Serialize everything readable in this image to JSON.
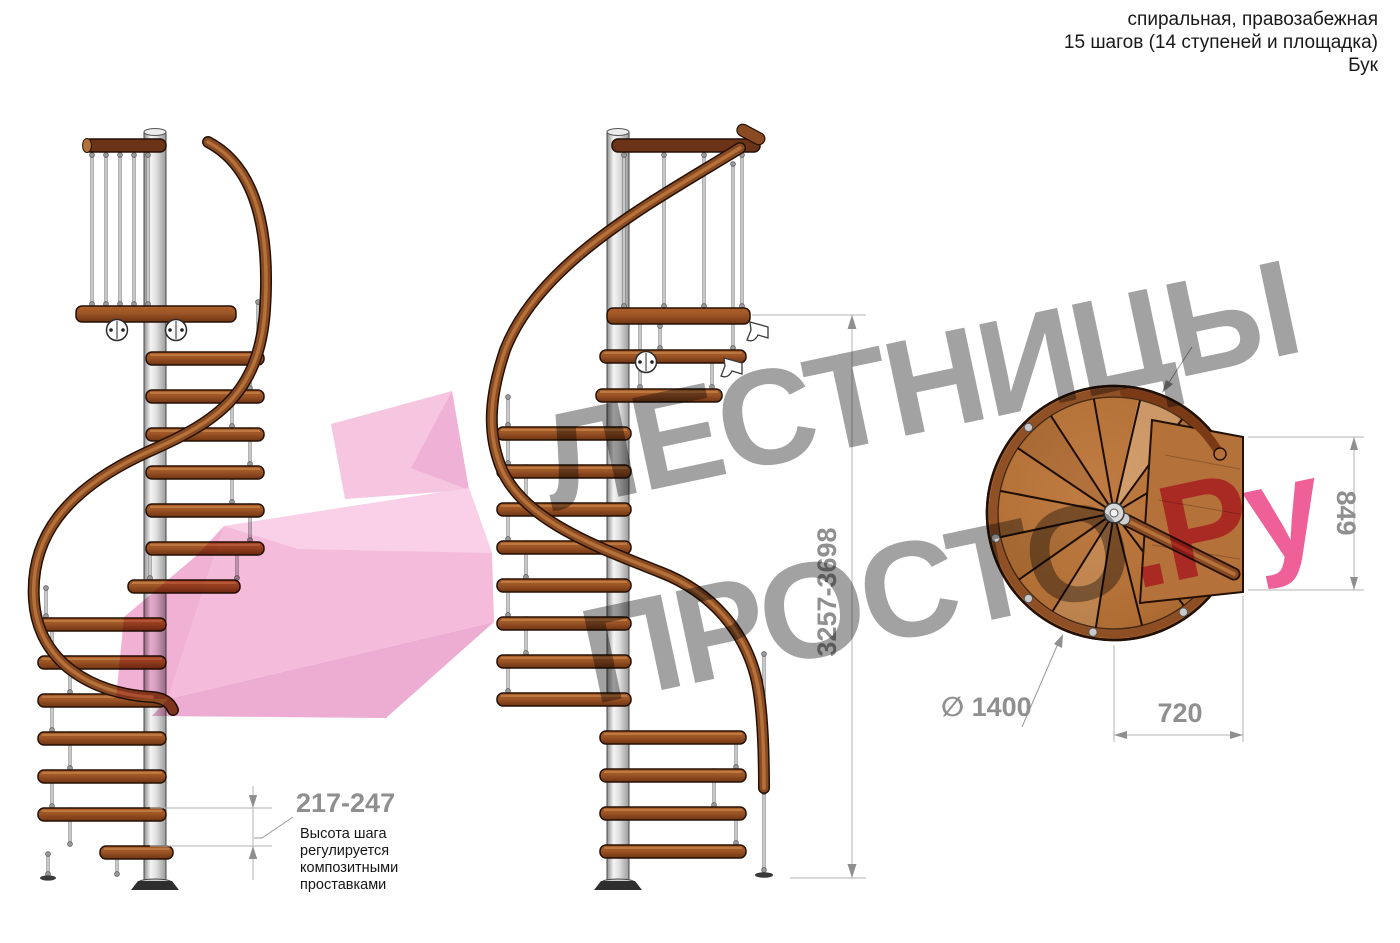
{
  "header": {
    "type_line": "спиральная, правозабежная",
    "steps_line": "15 шагов (14 ступеней и площадка)",
    "material_line": "Бук"
  },
  "watermark": {
    "line1": "ЛЕСТНИЦЫ",
    "line2": "ПРОСТО",
    "domain_suffix": ".Ру"
  },
  "dimensions": {
    "step_height": "217-247",
    "step_height_note": "Высота шага\nрегулируется\nкомпозитными\nпроставками",
    "total_height": "3257-3698",
    "landing_depth": "849",
    "landing_width": "720",
    "diameter": "∅ 1400"
  },
  "icons": {
    "diameter_symbol": "diameter-icon"
  },
  "colors": {
    "wood": "#9c5526",
    "wood_light": "#b5713a",
    "wood_dark": "#5f2d12",
    "plan_wood": "#b06e35",
    "metal_pole": "#d9d9d9",
    "dimension_gray": "#8f8f8f",
    "watermark_gray": "#a2a2a2",
    "watermark_pink": "#ef5f98",
    "arrow_pink": "#f3b5d8"
  }
}
